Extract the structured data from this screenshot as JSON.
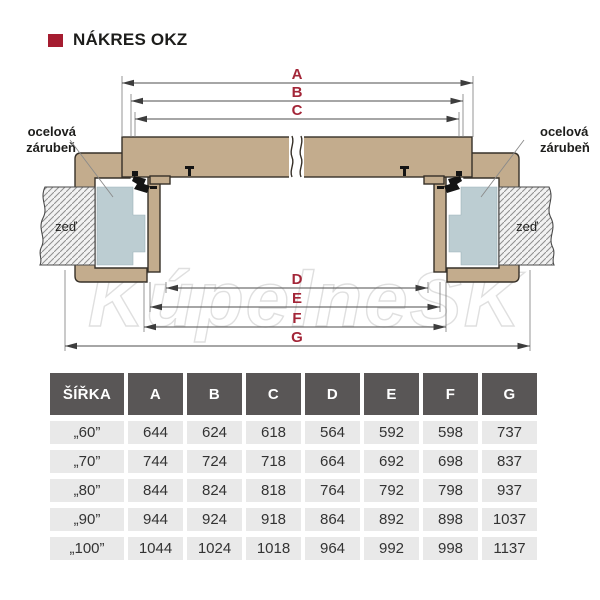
{
  "title": {
    "text": "NÁKRES OKZ"
  },
  "diagram": {
    "dim_labels": [
      "A",
      "B",
      "C",
      "D",
      "E",
      "F",
      "G"
    ],
    "labels": {
      "steel_frame_line1": "ocelová",
      "steel_frame_line2": "zárubeň",
      "wall": "zeď"
    },
    "watermark": "KúpelneSK",
    "colors": {
      "wood": "#c3ac8d",
      "steel_frame": "#bccdd2",
      "dim_letter": "#a32638",
      "bullet": "#a51c30"
    }
  },
  "table": {
    "headers": [
      "ŠÍŘKA",
      "A",
      "B",
      "C",
      "D",
      "E",
      "F",
      "G"
    ],
    "rows": [
      {
        "label": "„60”",
        "values": [
          "644",
          "624",
          "618",
          "564",
          "592",
          "598",
          "737"
        ]
      },
      {
        "label": "„70”",
        "values": [
          "744",
          "724",
          "718",
          "664",
          "692",
          "698",
          "837"
        ]
      },
      {
        "label": "„80”",
        "values": [
          "844",
          "824",
          "818",
          "764",
          "792",
          "798",
          "937"
        ]
      },
      {
        "label": "„90”",
        "values": [
          "944",
          "924",
          "918",
          "864",
          "892",
          "898",
          "1037"
        ]
      },
      {
        "label": "„100”",
        "values": [
          "1044",
          "1024",
          "1018",
          "964",
          "992",
          "998",
          "1137"
        ]
      }
    ],
    "header_bg": "#595656",
    "row_bg": "#e9e9e9"
  }
}
